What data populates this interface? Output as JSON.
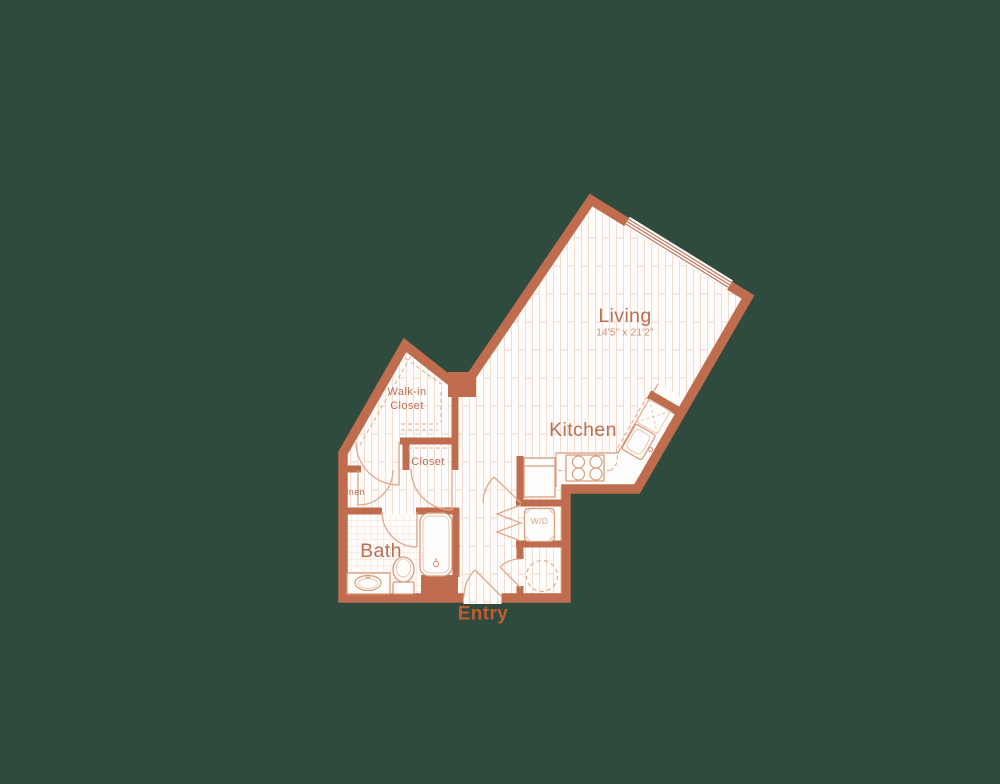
{
  "palette": {
    "background": "#2f4b3d",
    "wall": "#bf6c4f",
    "floor": "#fffdfb",
    "floor_pattern_line": "#f4dcce",
    "fixture_line": "#d89b7c",
    "door_arc": "#dfa98c",
    "room_label": "#bb6e51",
    "dimension_text": "#c98d72",
    "entry_label": "#c25c33"
  },
  "rooms": {
    "living": {
      "label": "Living",
      "dimensions": "14'5\" x 21'2\""
    },
    "kitchen": {
      "label": "Kitchen"
    },
    "walk_in_closet": {
      "label_line1": "Walk-in",
      "label_line2": "Closet"
    },
    "closet": {
      "label": "Closet"
    },
    "linen": {
      "label": "Linen"
    },
    "bath": {
      "label": "Bath"
    },
    "entry": {
      "label": "Entry"
    },
    "washer_dryer": {
      "label": "W/D"
    }
  }
}
